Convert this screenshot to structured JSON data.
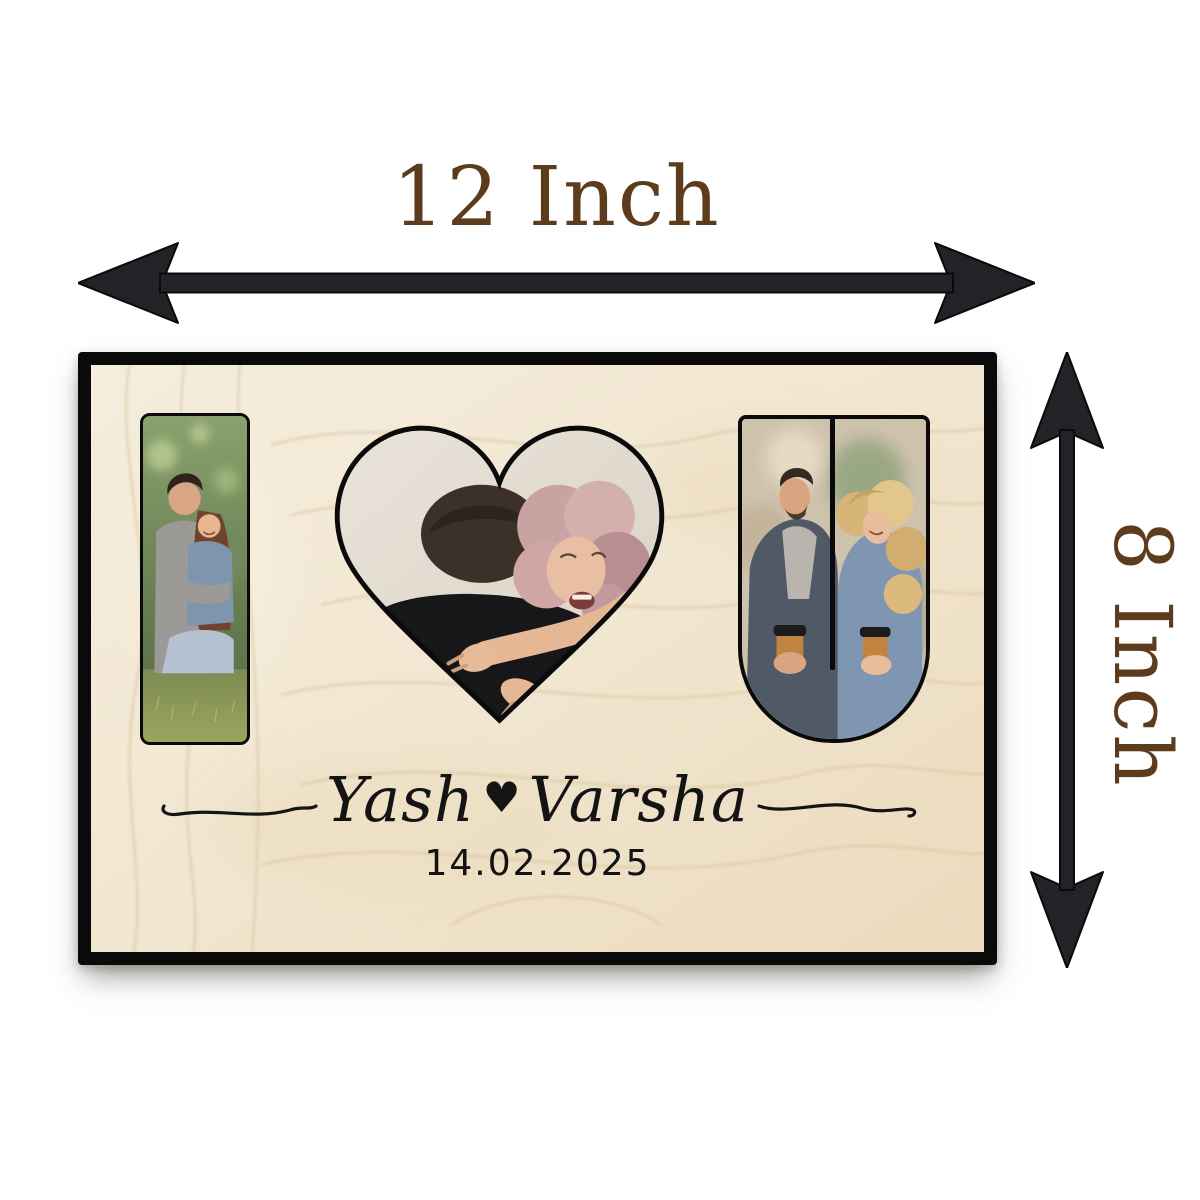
{
  "page": {
    "background_color": "#ffffff"
  },
  "dimension_annotations": {
    "width": {
      "label": "12 Inch"
    },
    "height": {
      "label": "8 Inch"
    },
    "label_color": "#5d3c1e",
    "arrow_color": "#232327"
  },
  "plaque": {
    "design_word": "I ♥ U",
    "border_color": "#0a0a0a",
    "wood_base_color": "#f2e8d4",
    "wood_grain_color": "#d9c49c",
    "engraving": {
      "name_left": "Yash",
      "separator_glyph": "♥",
      "name_right": "Varsha",
      "date": "14.02.2025",
      "ink_color": "#141414"
    },
    "photo_slots": {
      "letter_i": "couple sitting on grass, man in grey hugging woman in denim",
      "heart": "laughing curly-haired woman hugging man in black shirt seen from behind",
      "letter_u": "smiling couple in denim jackets holding coffee cups"
    }
  }
}
